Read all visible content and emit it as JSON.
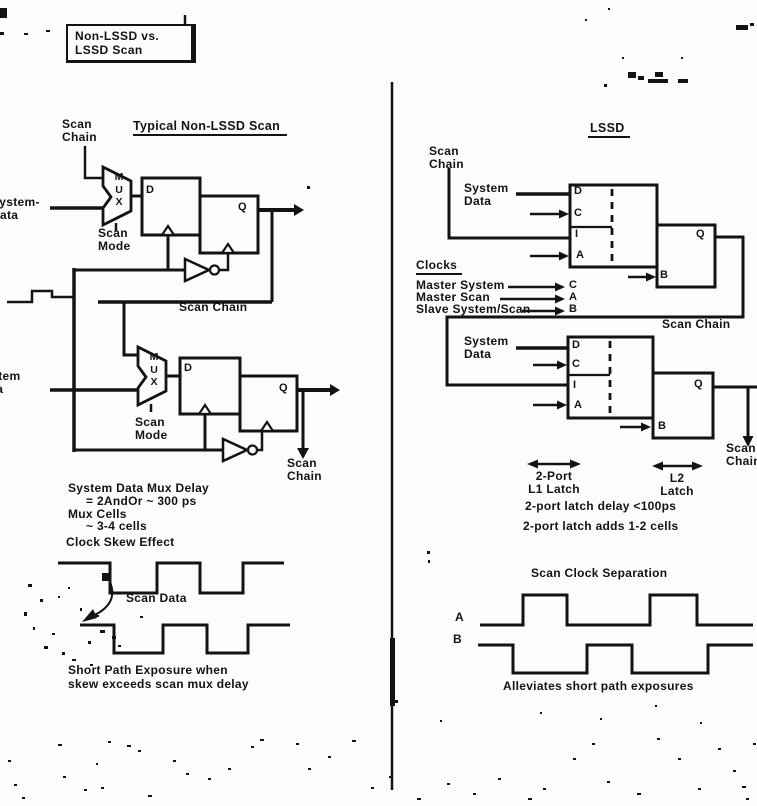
{
  "title_box": {
    "line1": "Non-LSSD vs.",
    "line2": "LSSD Scan"
  },
  "left": {
    "heading": "Typical Non-LSSD Scan",
    "scan_chain_top": {
      "line1": "Scan",
      "line2": "Chain"
    },
    "system_data_top": {
      "line1": "System-",
      "line2": "Data"
    },
    "mux_top": {
      "m": "M",
      "u": "U",
      "x": "X"
    },
    "scan_mode_top": {
      "line1": "Scan",
      "line2": "Mode"
    },
    "ff_top": {
      "d": "D",
      "q": "Q"
    },
    "scan_chain_mid": "Scan Chain",
    "system_data_bottom": {
      "line1": "System",
      "line2": "Data"
    },
    "mux_bottom": {
      "m": "M",
      "u": "U",
      "x": "X"
    },
    "scan_mode_bottom": {
      "line1": "Scan",
      "line2": "Mode"
    },
    "ff_bottom": {
      "d": "D",
      "q": "Q"
    },
    "scan_chain_out": {
      "line1": "Scan",
      "line2": "Chain"
    },
    "note_mux_delay_1": "System Data Mux Delay",
    "note_mux_delay_2": "= 2AndOr ~ 300 ps",
    "note_mux_cells_1": "Mux Cells",
    "note_mux_cells_2": "~ 3-4 cells",
    "note_clock_skew": "Clock Skew Effect",
    "scan_data": "Scan Data",
    "note_exposure_1": "Short Path Exposure when",
    "note_exposure_2": "skew exceeds scan mux delay"
  },
  "right": {
    "heading": "LSSD",
    "scan_chain_top": {
      "line1": "Scan",
      "line2": "Chain"
    },
    "system_data_top": {
      "line1": "System",
      "line2": "Data"
    },
    "latch1_ports": {
      "d": "D",
      "c": "C",
      "i": "I",
      "a": "A"
    },
    "latch2_ports": {
      "q": "Q",
      "b": "B"
    },
    "clocks_heading": "Clocks",
    "clock_master_system": "Master System",
    "clock_master_system_port": "C",
    "clock_master_scan": "Master Scan",
    "clock_master_scan_port": "A",
    "clock_slave": "Slave System/Scan",
    "clock_slave_port": "B",
    "scan_chain_mid": "Scan Chain",
    "system_data_bottom": {
      "line1": "System",
      "line2": "Data"
    },
    "latch3_ports": {
      "d": "D",
      "c": "C",
      "i": "I",
      "a": "A"
    },
    "latch4_ports": {
      "q": "Q",
      "b": "B"
    },
    "scan_chain_out": {
      "line1": "Scan",
      "line2": "Chain"
    },
    "l1_measure": {
      "line1": "2-Port",
      "line2": "L1 Latch"
    },
    "l2_measure": {
      "line1": "L2",
      "line2": "Latch"
    },
    "note_delay": "2-port latch delay <100ps",
    "note_cells": "2-port latch adds 1-2 cells",
    "clock_sep_heading": "Scan Clock Separation",
    "wave_a": "A",
    "wave_b": "B",
    "footer_note": "Alleviates short path exposures"
  },
  "colors": {
    "ink": "#131313",
    "paper": "#fcfcfc"
  }
}
